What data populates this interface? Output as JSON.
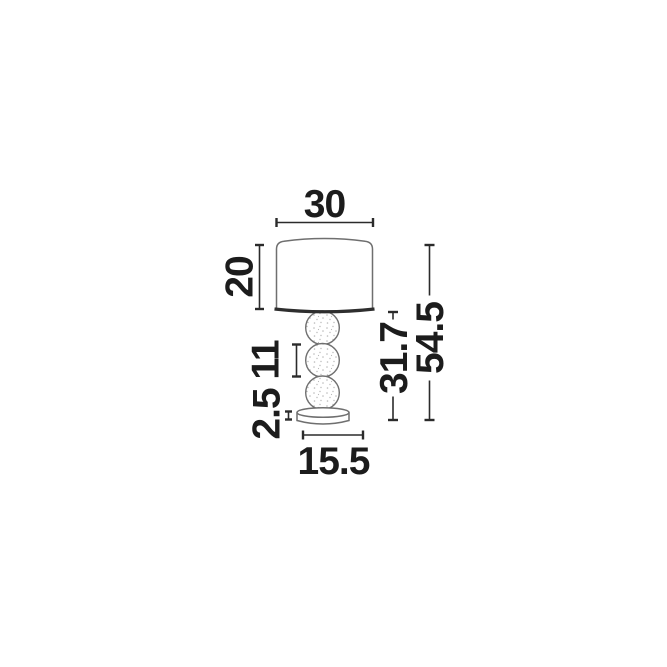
{
  "diagram": {
    "type": "table-lamp-dimension-drawing",
    "labels": {
      "shade_width": "30",
      "shade_height": "20",
      "sphere_diameter": "11",
      "base_thickness": "2.5",
      "base_width": "15.5",
      "stand_height": "31.7",
      "total_height": "54.5"
    },
    "colors": {
      "background": "#ffffff",
      "text": "#1c1c1c",
      "dimension_line": "#2b2b2b",
      "outline": "#6f6f6f",
      "shade_rim": "#2e2e2e",
      "stipple": "#b9b9b9"
    }
  }
}
